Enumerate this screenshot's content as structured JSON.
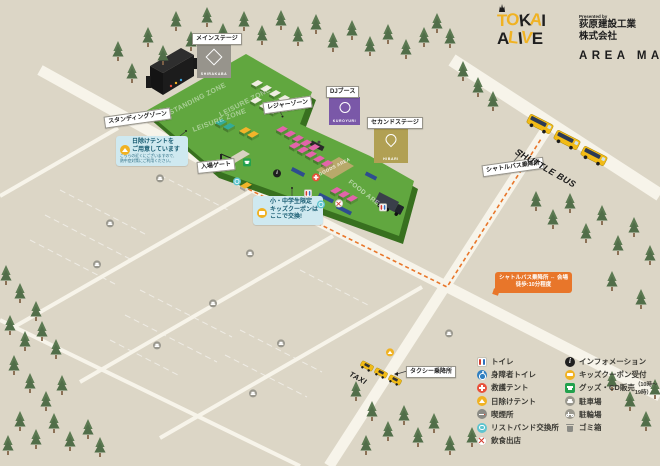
{
  "logo": {
    "title_line1": "TOKAI",
    "title_line2": "ALIVE",
    "letter_colors_line1": [
      "#f0b222",
      "#f0b222",
      "#1f1f1f",
      "#f0b222",
      "#1f1f1f"
    ],
    "letter_colors_line2": [
      "#1f1f1f",
      "#f0b222",
      "#1f1f1f",
      "#f0b222",
      "#1f1f1f"
    ],
    "presented_by": "Presented by",
    "company_line1": "荻原建設工業",
    "company_line2": "株式会社",
    "area_map": "AREA MAP"
  },
  "stages": {
    "main": {
      "label": "メインステージ",
      "name": "SHIRAKABA",
      "color": "#97948c"
    },
    "dj": {
      "label": "DJブース",
      "name": "KUROYURI",
      "color": "#7a58a8"
    },
    "second": {
      "label": "セカンドステージ",
      "name": "HIBARI",
      "color": "#b1a053"
    }
  },
  "zones": {
    "standing_label": "スタンディングゾーン",
    "leisure_label": "レジャーゾーン",
    "standing_field": "STANDING ZONE",
    "leisure_field": "LEISURE ZONE",
    "leisure_field2": "LEISURE ZONE",
    "goods_field": "GOODS AREA",
    "food_field": "FOOD AREA"
  },
  "gate": {
    "label": "入場ゲート"
  },
  "transport": {
    "shuttle_text": "SHUTTLE BUS",
    "shuttle_stop_label": "シャトルバス乗降所",
    "taxi_text": "TAXI",
    "taxi_stop_label": "タクシー乗降所",
    "shuttle_note_line1": "シャトルバス乗降所 ⇔ 会場",
    "shuttle_note_line2": "徒歩:10分程度"
  },
  "callouts": {
    "shade": {
      "title1": "日除けテントを",
      "title2": "ご用意しています",
      "body1": "こちらの近くにございますので、",
      "body2": "熱中症対策にご利用ください。"
    },
    "kids": {
      "line1": "小・中学生限定",
      "line2": "キッズクーポンは",
      "line3": "ここで交換!"
    }
  },
  "legend": {
    "left": [
      {
        "icon": "toilet",
        "label": "トイレ"
      },
      {
        "icon": "accessible-toilet",
        "label": "身障者トイレ"
      },
      {
        "icon": "first-aid-tent",
        "label": "救護テント"
      },
      {
        "icon": "shade-tent",
        "label": "日除けテント"
      },
      {
        "icon": "smoking-area",
        "label": "喫煙所"
      },
      {
        "icon": "wristband-exchange",
        "label": "リストバンド交換所"
      },
      {
        "icon": "food-stalls",
        "label": "飲食出店"
      }
    ],
    "right": [
      {
        "icon": "information",
        "label": "インフォメーション"
      },
      {
        "icon": "kids-coupon",
        "label": "キッズクーポン受付"
      },
      {
        "icon": "goods-cd",
        "label": "グッズ・CD販売",
        "sub": "（10時〜19時）"
      },
      {
        "icon": "parking",
        "label": "駐車場"
      },
      {
        "icon": "bicycle-parking",
        "label": "駐輪場"
      },
      {
        "icon": "trash",
        "label": "ゴミ箱"
      }
    ]
  },
  "colors": {
    "background": "#dcd6c6",
    "road": "#f7f4ea",
    "grass": "#61a73f",
    "grass_shadow": "#38701f",
    "accent_yellow": "#f0b222",
    "callout_blue": "#cfe9f0",
    "note_orange": "#e8762a"
  }
}
